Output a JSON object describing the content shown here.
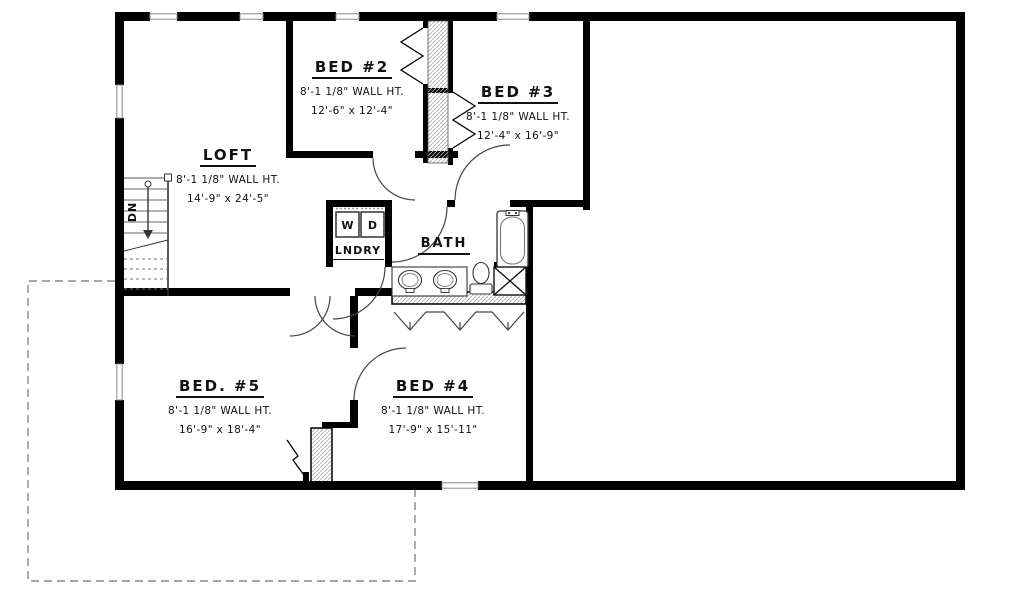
{
  "plan": {
    "rooms": {
      "loft": {
        "name": "LOFT",
        "wall_ht": "8'-1 1/8\" WALL HT.",
        "dims": "14'-9\" x 24'-5\""
      },
      "bed2": {
        "name": "BED #2",
        "wall_ht": "8'-1 1/8\" WALL HT.",
        "dims": "12'-6\" x 12'-4\""
      },
      "bed3": {
        "name": "BED #3",
        "wall_ht": "8'-1 1/8\" WALL HT.",
        "dims": "12'-4\" x 16'-9\""
      },
      "bed4": {
        "name": "BED #4",
        "wall_ht": "8'-1 1/8\" WALL HT.",
        "dims": "17'-9\" x 15'-11\""
      },
      "bed5": {
        "name": "BED. #5",
        "wall_ht": "8'-1 1/8\" WALL HT.",
        "dims": "16'-9\" x 18'-4\""
      },
      "bath": {
        "name": "BATH"
      },
      "laundry": {
        "name": "LNDRY",
        "washer": "W",
        "dryer": "D"
      }
    },
    "stairs": {
      "direction": "DN"
    },
    "colors": {
      "wall": "#000000",
      "line": "#444444",
      "hatch": "#b0b0b0",
      "dashed_outline": "#888888",
      "background": "#ffffff"
    }
  }
}
